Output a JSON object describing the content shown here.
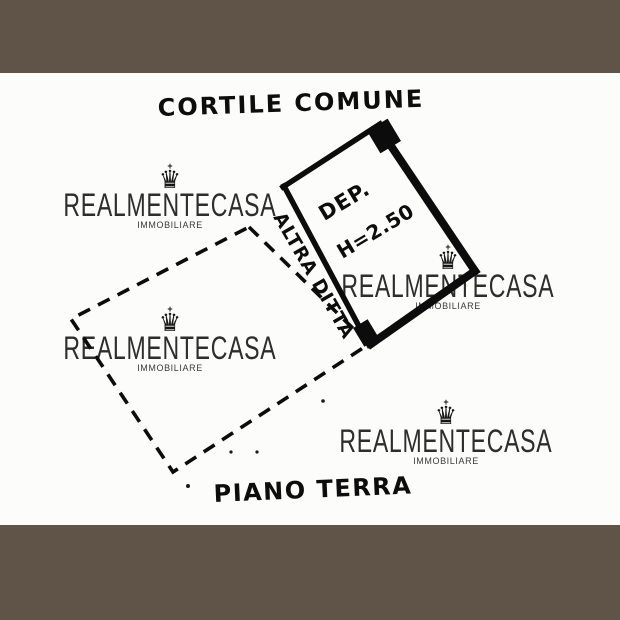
{
  "frame": {
    "color": "#5f5447"
  },
  "canvas": {
    "background": "#fcfcfb",
    "ink": "#0d0d0d"
  },
  "plan": {
    "courtyard_label": "CORTILE COMUNE",
    "room_label_line1": "DEP.",
    "room_label_line2": "H=2.50",
    "adjacent_property_label": "ALTRA DITTA",
    "floor_label": "PIANO TERRA"
  },
  "watermark": {
    "brand": "REALMENTECASA",
    "subtitle": "IMMOBILIARE",
    "crown_glyph": "♛",
    "cross_glyph": "+"
  }
}
